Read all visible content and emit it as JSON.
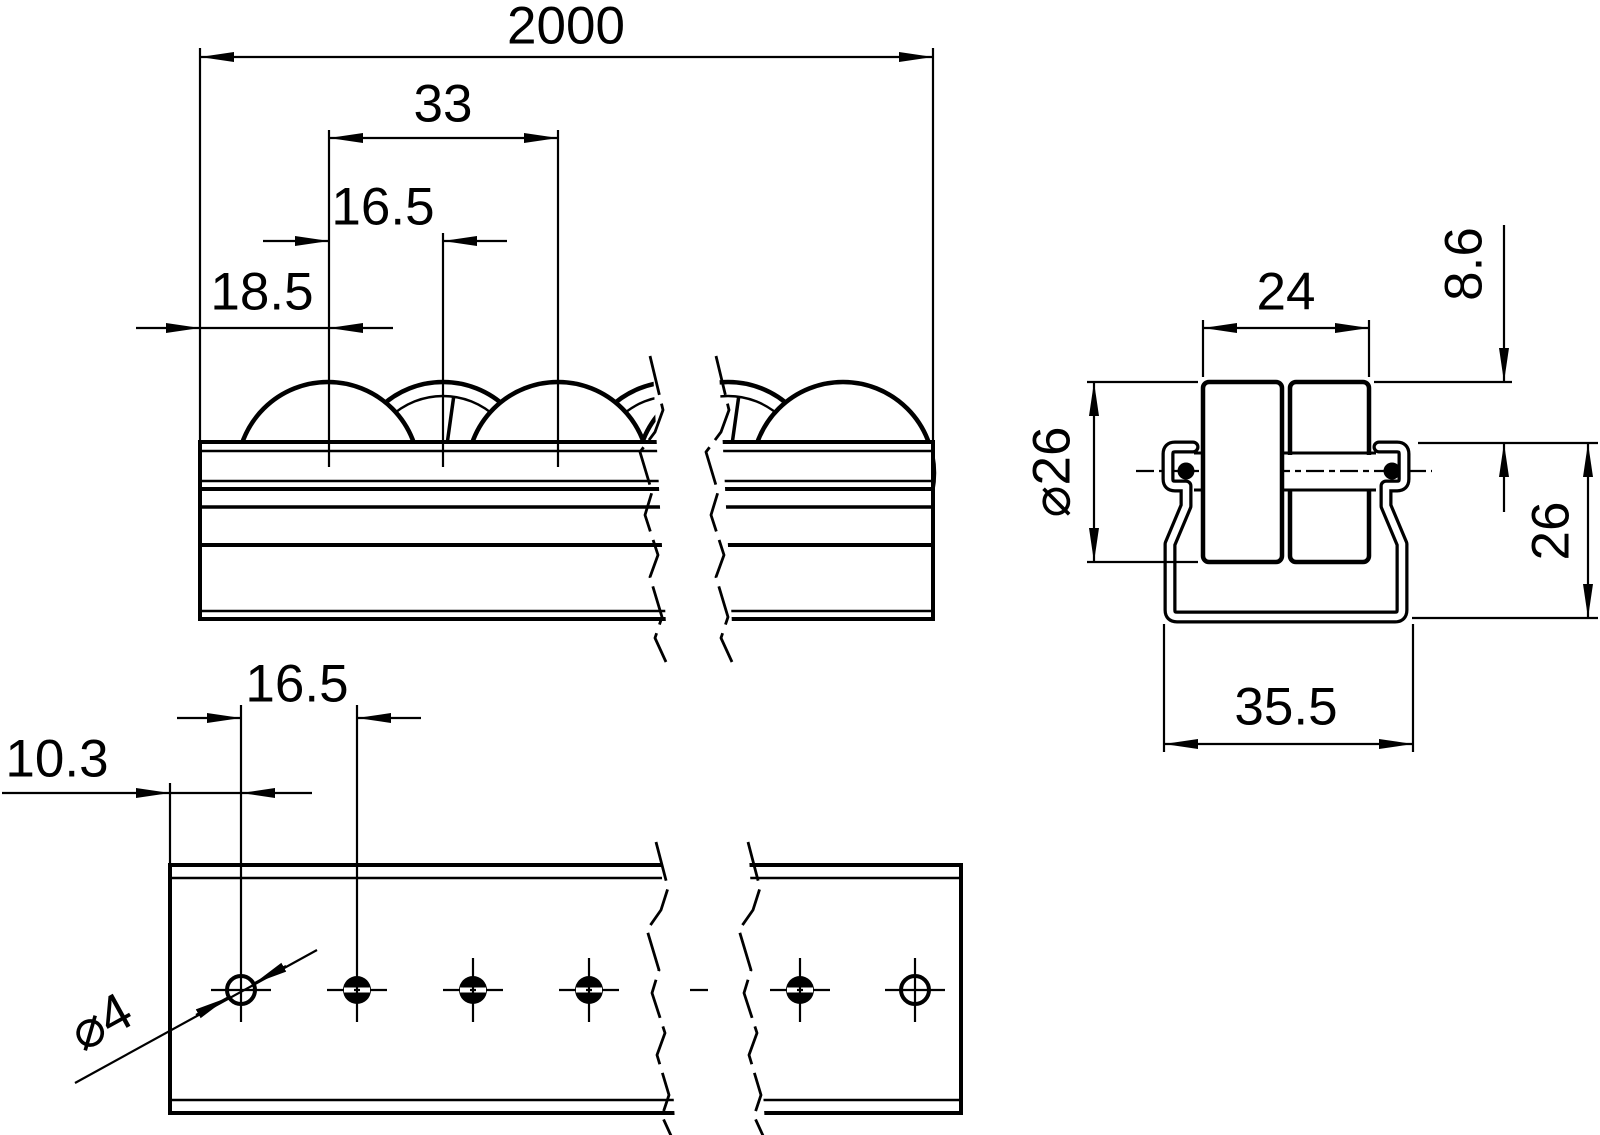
{
  "drawing_type": "technical-dimension-drawing",
  "subject": "roller track rail with wheels, three orthographic views (side view, end section view, bottom hole view)",
  "colors": {
    "line": "#000000",
    "background": "#ffffff"
  },
  "labels": {
    "overall_length": "2000",
    "roller_double_pitch": "33",
    "roller_pitch": "16.5",
    "first_roller_offset": "18.5",
    "roller_pair_width": "24",
    "roller_protrusion": "8.6",
    "roller_diameter": "⌀26",
    "rail_height": "26",
    "rail_width": "35.5",
    "hole_pitch": "16.5",
    "first_hole_offset": "10.3",
    "hole_diameter": "⌀4"
  }
}
